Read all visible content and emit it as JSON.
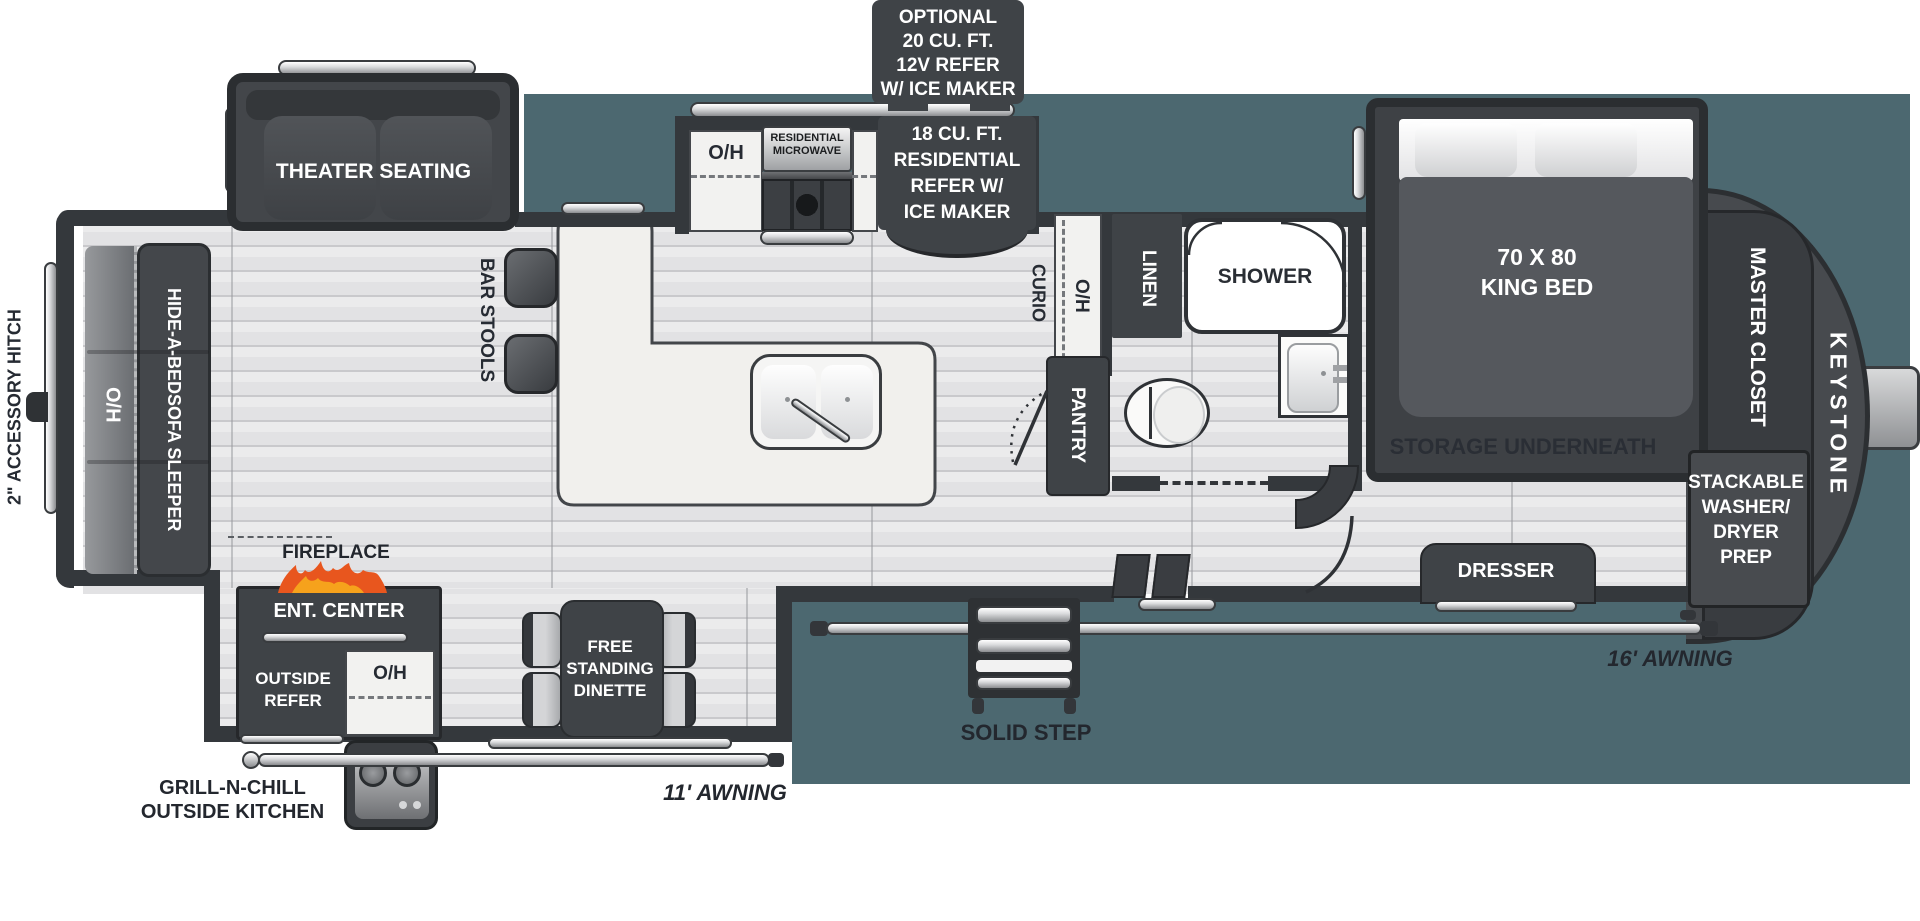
{
  "colors": {
    "teal_background": "#4c6870",
    "wall": "#34383c",
    "dark_furniture": "#3f4347",
    "floor_light": "#e4e4e6",
    "counter": "#f1f0ed",
    "flame_orange": "#e8561e",
    "flame_yellow": "#f6a21c",
    "label_dark": "#262b33",
    "label_white": "#ffffff"
  },
  "exterior": {
    "hitch": "2\" ACCESSORY HITCH",
    "awning_rear": "11' AWNING",
    "awning_front": "16' AWNING",
    "step": "SOLID STEP",
    "outside_kitchen": [
      "GRILL-N-CHILL",
      "OUTSIDE KITCHEN"
    ],
    "brand": "KEYSTONE",
    "optional_refer": [
      "OPTIONAL",
      "20 CU. FT.",
      "12V REFER",
      "W/ ICE MAKER"
    ]
  },
  "living": {
    "theater": "THEATER SEATING",
    "sofa": [
      "HIDE-A-BED",
      "SOFA SLEEPER"
    ],
    "sofa_oh": "O/H",
    "fireplace": "FIREPLACE",
    "ent_center": "ENT. CENTER",
    "outside_refer": [
      "OUTSIDE",
      "REFER"
    ],
    "outside_oh": "O/H",
    "dinette": [
      "FREE",
      "STANDING",
      "DINETTE"
    ],
    "bar_stools": "BAR STOOLS"
  },
  "kitchen": {
    "oh": "O/H",
    "microwave": [
      "RESIDENTIAL",
      "MICROWAVE"
    ],
    "refer": [
      "18 CU. FT.",
      "RESIDENTIAL",
      "REFER W/",
      "ICE MAKER"
    ],
    "curio": "CURIO",
    "hall_oh": "O/H",
    "pantry": "PANTRY"
  },
  "bath": {
    "linen": "LINEN",
    "shower": "SHOWER"
  },
  "bedroom": {
    "bed": [
      "70 X 80",
      "KING BED"
    ],
    "storage": "STORAGE UNDERNEATH",
    "closet": "MASTER CLOSET",
    "washer": [
      "STACKABLE",
      "WASHER/",
      "DRYER",
      "PREP"
    ],
    "dresser": "DRESSER"
  }
}
